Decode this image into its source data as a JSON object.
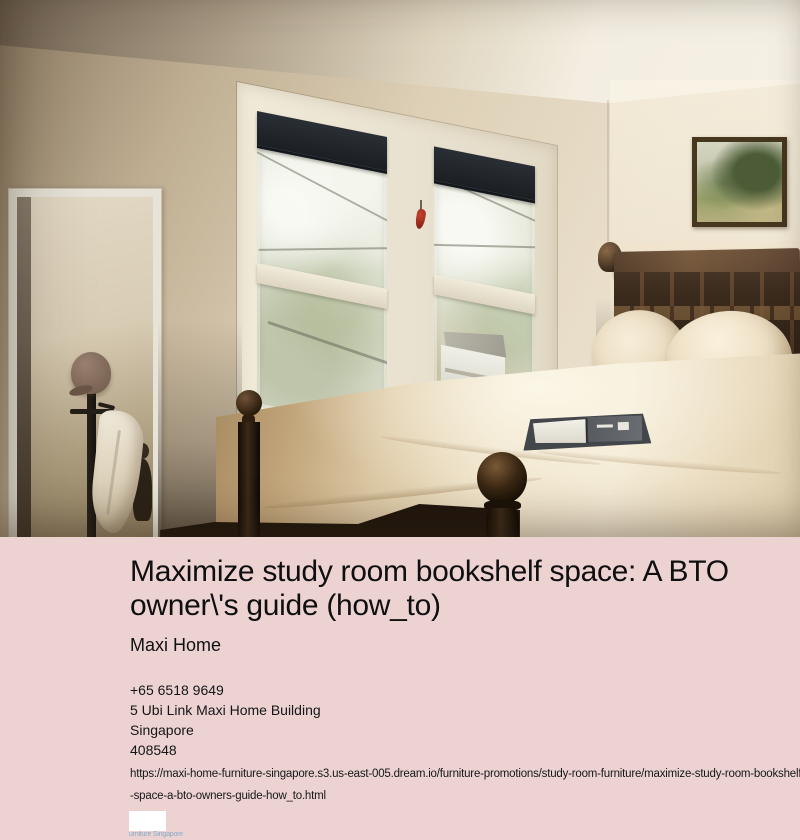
{
  "photo": {
    "description": "Bedroom with double-hung windows showing trees and a neighboring house, dark wood bed with cream pillows and tan duvet, open book on bed, leaning floor mirror, coat rack with cap and white garment, framed landscape painting"
  },
  "listing": {
    "title": "Maximize study room bookshelf space: A BTO owner\\'s guide (how_to)",
    "brand": "Maxi Home",
    "phone": "+65 6518 9649",
    "address_line": "5 Ubi Link Maxi Home Building",
    "city": "Singapore",
    "postal_code": "408548",
    "url_line1": "https://maxi-home-furniture-singapore.s3.us-east-005.dream.io/furniture-promotions/study-room-furniture/maximize-study-room-bookshelf",
    "url_line2": "-space-a-bto-owners-guide-how_to.html",
    "logo_caption": "urniture Singapore"
  },
  "colors": {
    "section_background": "#ecd3d2",
    "text": "#131313",
    "logo_caption_blue": "#86a8c4",
    "window_shade": "#1f2328",
    "headboard_wood": "#3a2a1c",
    "duvet_cream": "#eee2c8",
    "duvet_tan": "#a4885f"
  }
}
